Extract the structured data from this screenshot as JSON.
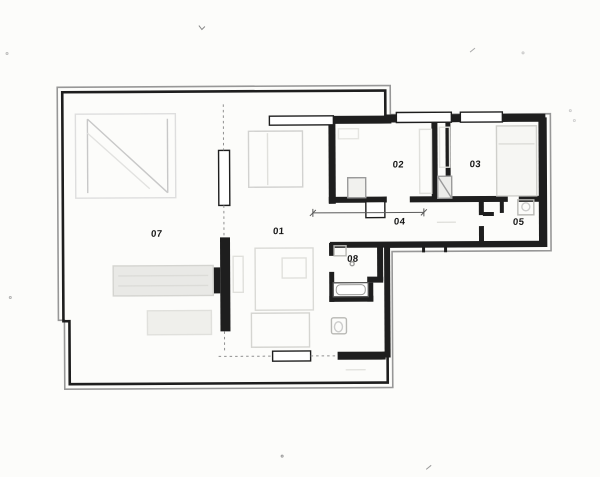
{
  "plan": {
    "room_labels": [
      {
        "id": "01",
        "text": "01"
      },
      {
        "id": "02",
        "text": "02"
      },
      {
        "id": "03",
        "text": "03"
      },
      {
        "id": "04",
        "text": "04"
      },
      {
        "id": "05",
        "text": "05"
      },
      {
        "id": "07",
        "text": "07"
      },
      {
        "id": "08",
        "text": "08"
      }
    ]
  },
  "colors": {
    "paper": "#fcfcfa",
    "wall": "#1e1e1e",
    "outer": "#979797",
    "sketch": "#c8c8c8",
    "label": "#161616"
  }
}
